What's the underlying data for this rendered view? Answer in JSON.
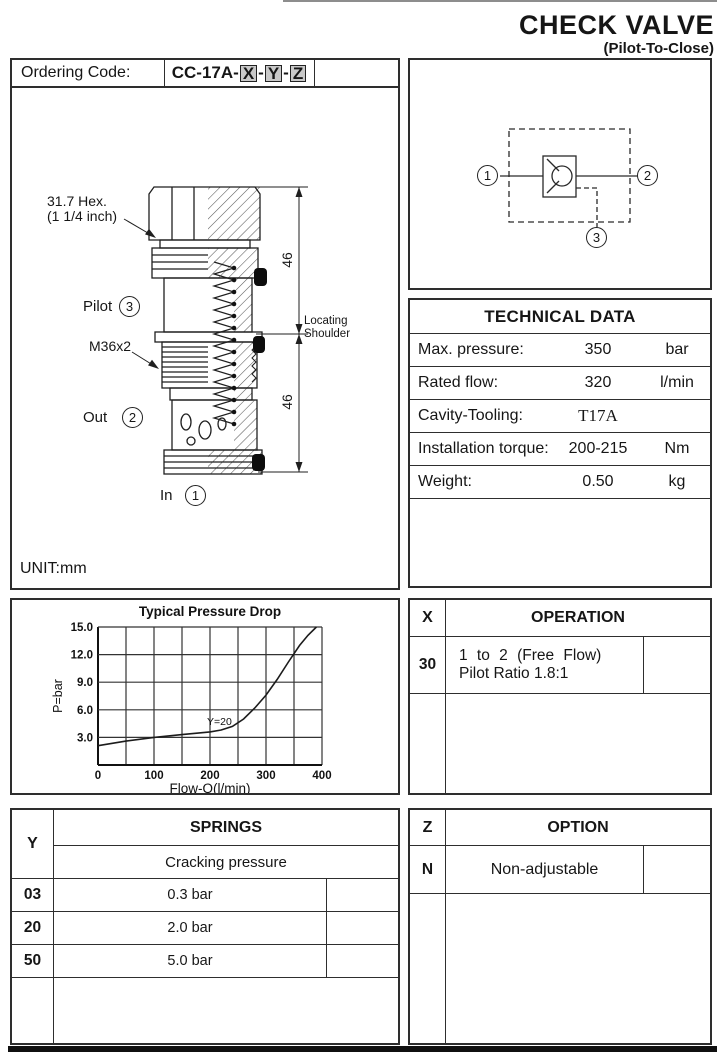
{
  "header": {
    "title": "CHECK VALVE",
    "subtitle": "(Pilot-To-Close)"
  },
  "ordering": {
    "label": "Ordering Code:",
    "prefix": "CC-17A-",
    "x": "X",
    "y": "Y",
    "z": "Z",
    "sep": "-"
  },
  "drawing": {
    "hex_line1": "31.7 Hex.",
    "hex_line2": "(1 1/4 inch)",
    "pilot_label": "Pilot",
    "pilot_port": "3",
    "thread_label": "M36x2",
    "out_label": "Out",
    "out_port": "2",
    "in_label": "In",
    "in_port": "1",
    "dim_top": "46",
    "dim_bottom": "46",
    "shoulder_line1": "Locating",
    "shoulder_line2": "Shoulder",
    "unit": "UNIT:mm"
  },
  "schematic": {
    "port1": "1",
    "port2": "2",
    "port3": "3"
  },
  "technical_data": {
    "title": "TECHNICAL DATA",
    "rows": [
      {
        "label": "Max. pressure:",
        "value": "350",
        "unit": "bar"
      },
      {
        "label": "Rated flow:",
        "value": "320",
        "unit": "l/min"
      },
      {
        "label": "Cavity-Tooling:",
        "value": "T17A",
        "unit": ""
      },
      {
        "label": "Installation torque:",
        "value": "200-215",
        "unit": "Nm"
      },
      {
        "label": "Weight:",
        "value": "0.50",
        "unit": "kg"
      }
    ]
  },
  "chart_data": {
    "type": "line",
    "title": "Typical Pressure Drop",
    "xlabel": "Flow-Q(l/min)",
    "ylabel": "P=bar",
    "xlim": [
      0,
      400
    ],
    "ylim": [
      0,
      15
    ],
    "xticks": [
      0,
      100,
      200,
      300,
      400
    ],
    "yticks": [
      3.0,
      6.0,
      9.0,
      12.0,
      15.0
    ],
    "x_grid_step": 50,
    "y_grid_step": 3,
    "grid": true,
    "legend_position": "none",
    "series": [
      {
        "name": "Y=20",
        "points": [
          [
            0,
            2.1
          ],
          [
            50,
            2.6
          ],
          [
            100,
            3.0
          ],
          [
            150,
            3.3
          ],
          [
            200,
            3.6
          ],
          [
            220,
            3.8
          ],
          [
            240,
            4.2
          ],
          [
            260,
            5.0
          ],
          [
            280,
            6.2
          ],
          [
            300,
            7.6
          ],
          [
            320,
            9.3
          ],
          [
            340,
            11.2
          ],
          [
            360,
            13.0
          ],
          [
            375,
            14.1
          ],
          [
            390,
            15.0
          ]
        ]
      }
    ],
    "annotation": {
      "text": "Y=20",
      "x": 200,
      "y": 4.7
    }
  },
  "operation": {
    "code_header": "X",
    "title": "OPERATION",
    "rows": [
      {
        "code": "30",
        "line1": "1 to 2 (Free Flow)",
        "line2": "Pilot Ratio 1.8:1"
      }
    ]
  },
  "springs": {
    "code_header": "Y",
    "title": "SPRINGS",
    "subtitle": "Cracking pressure",
    "rows": [
      {
        "code": "03",
        "value": "0.3 bar"
      },
      {
        "code": "20",
        "value": "2.0 bar"
      },
      {
        "code": "50",
        "value": "5.0 bar"
      }
    ]
  },
  "option": {
    "code_header": "Z",
    "title": "OPTION",
    "rows": [
      {
        "code": "N",
        "value": "Non-adjustable"
      }
    ]
  }
}
